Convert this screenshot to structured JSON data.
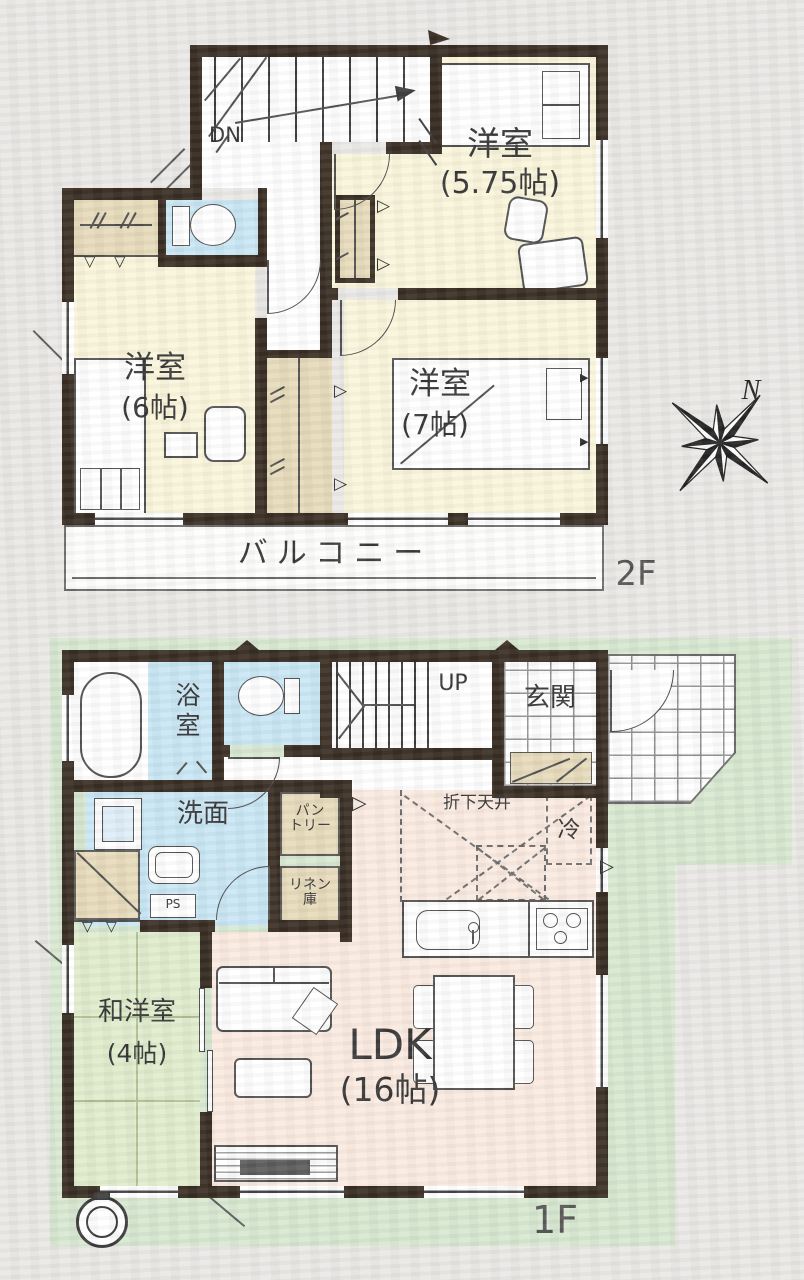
{
  "compass": {
    "north": "N"
  },
  "floor2": {
    "label": "2F",
    "stairs": "DN",
    "balcony": "バルコニー",
    "room_575": {
      "name": "洋室",
      "size": "(5.75帖)"
    },
    "room_6": {
      "name": "洋室",
      "size": "(6帖)"
    },
    "room_7": {
      "name": "洋室",
      "size": "(7帖)"
    }
  },
  "floor1": {
    "label": "1F",
    "stairs": "UP",
    "bathroom": "浴室",
    "washroom": "洗面",
    "entrance": "玄関",
    "pantry": "パン\nトリー",
    "linen": "リネン\n庫",
    "pipe_space": "PS",
    "lowered_ceiling": "折下天井",
    "refrigerator": "冷",
    "washitsu": {
      "name": "和洋室",
      "size": "(4帖)"
    },
    "ldk": {
      "name": "LDK",
      "size": "(16帖)"
    }
  },
  "colors": {
    "wall": "#31251a",
    "room_cream": "#faf6da",
    "closet_tan": "#e6d9b8",
    "water_blue": "#c8e6f4",
    "ldk_peach": "#fbeadf",
    "tatami_green": "#dfecca",
    "site_green": "#d6e7ce",
    "background": "#eae8e5"
  }
}
